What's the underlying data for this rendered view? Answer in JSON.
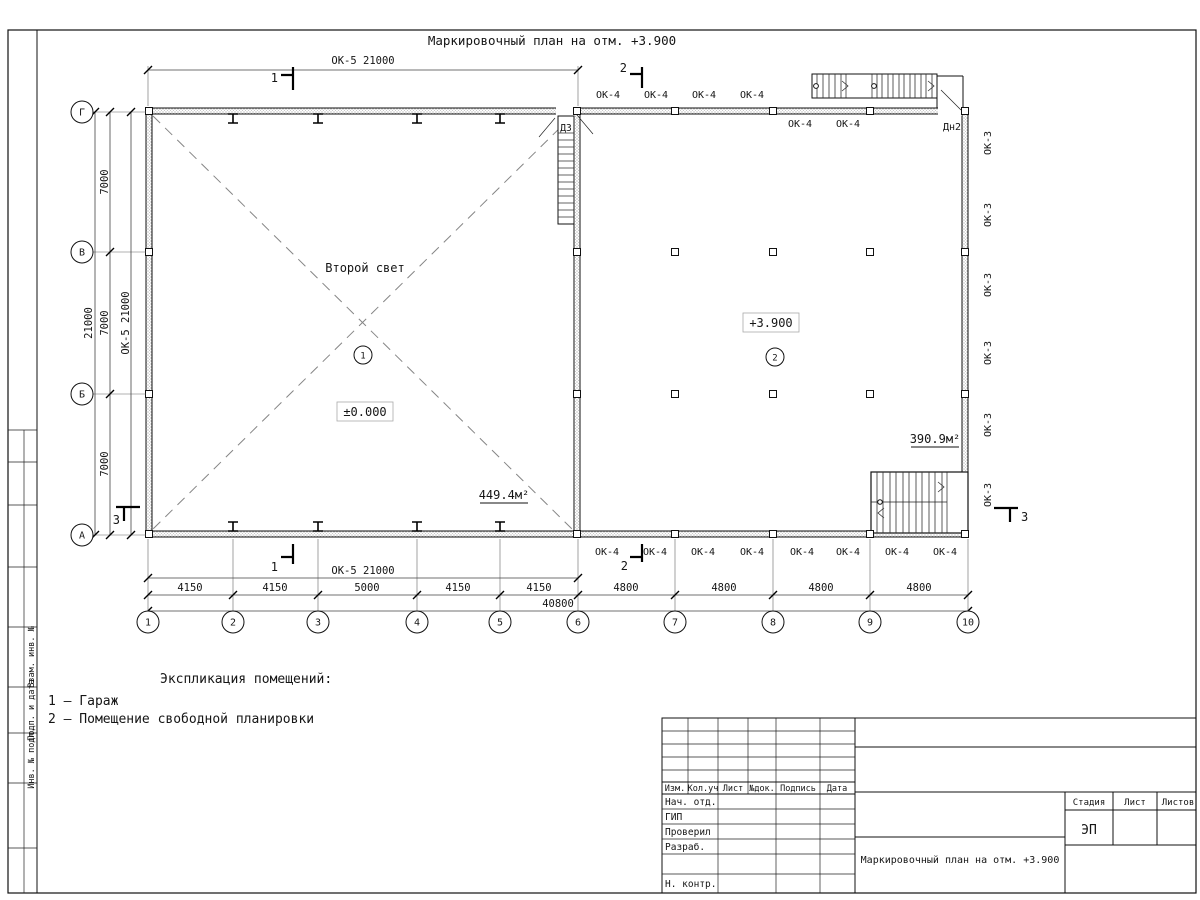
{
  "sheet": {
    "title": "Маркировочный план на отм. +3.900",
    "side_stamp": [
      "Взам. инв. №",
      "Подп. и дата",
      "Инв. № подл."
    ]
  },
  "plan": {
    "grid": {
      "cols": [
        "1",
        "2",
        "3",
        "4",
        "5",
        "6",
        "7",
        "8",
        "9",
        "10"
      ],
      "rows": [
        "Г",
        "В",
        "Б",
        "А"
      ]
    },
    "dims": {
      "ok5_band": "ОК-5 21000",
      "left_total": "21000",
      "left_segments": [
        "7000",
        "7000",
        "7000"
      ],
      "bottom_segments": [
        "4150",
        "4150",
        "5000",
        "4150",
        "4150",
        "4800",
        "4800",
        "4800",
        "4800"
      ],
      "bottom_total": "40800"
    },
    "marks": {
      "ok4": "ОК-4",
      "ok3": "ОК-3",
      "dn2": "Дн2",
      "d3": "ДЗ"
    },
    "sections": {
      "s1": "1",
      "s2": "2",
      "s3": "3"
    },
    "rooms": [
      {
        "num": "1",
        "label": "Второй свет",
        "elevation": "±0.000",
        "area": "449.4м²"
      },
      {
        "num": "2",
        "elevation": "+3.900",
        "area": "390.9м²"
      }
    ]
  },
  "legend": {
    "heading": "Экспликация помещений:",
    "items": [
      "1 – Гараж",
      "2 – Помещение свободной планировки"
    ]
  },
  "titleblock": {
    "headers": [
      "Изм.",
      "Кол.уч",
      "Лист",
      "№док.",
      "Подпись",
      "Дата"
    ],
    "staff": [
      "Нач. отд.",
      "ГИП",
      "Проверил",
      "Разраб.",
      "Н. контр."
    ],
    "stage_label": "Стадия",
    "sheet_label": "Лист",
    "sheets_label": "Листов",
    "stage": "ЭП",
    "doc_title": "Маркировочный план на отм. +3.900"
  }
}
